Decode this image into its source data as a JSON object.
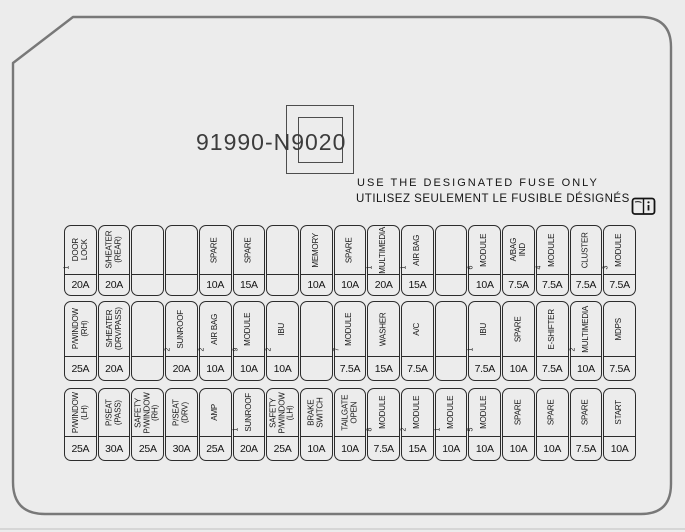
{
  "part_number": "91990-N9020",
  "notice": {
    "line_en": "USE THE DESIGNATED FUSE ONLY",
    "line_fr": "UTILISEZ SEULEMENT LE FUSIBLE DÉSIGNÉS",
    "icon": "owners-manual-book-icon"
  },
  "colors": {
    "background": "#ececec",
    "cell_line": "#2c2c2c",
    "casing_line": "#787878",
    "text": "#1a1a1a"
  },
  "fuse_rows": [
    {
      "cells": [
        {
          "label": "DOOR\nLOCK",
          "sup": "1",
          "amp": "20A"
        },
        {
          "label": "S/HEATER\n(REAR)",
          "sup": "",
          "amp": "20A"
        },
        {
          "label": "",
          "sup": "",
          "amp": ""
        },
        {
          "label": "",
          "sup": "",
          "amp": ""
        },
        {
          "label": "SPARE",
          "sup": "",
          "amp": "10A"
        },
        {
          "label": "SPARE",
          "sup": "",
          "amp": "15A"
        },
        {
          "label": "",
          "sup": "",
          "amp": ""
        },
        {
          "label": "MEMORY",
          "sup": "",
          "amp": "10A"
        },
        {
          "label": "SPARE",
          "sup": "",
          "amp": "10A"
        },
        {
          "label": "MULTIMEDIA",
          "sup": "1",
          "amp": "20A"
        },
        {
          "label": "AIR BAG",
          "sup": "1",
          "amp": "15A"
        },
        {
          "label": "",
          "sup": "",
          "amp": ""
        },
        {
          "label": "MODULE",
          "sup": "6",
          "amp": "10A"
        },
        {
          "label": "A/BAG\nIND",
          "sup": "",
          "amp": "7.5A"
        },
        {
          "label": "MODULE",
          "sup": "4",
          "amp": "7.5A"
        },
        {
          "label": "CLUSTER",
          "sup": "",
          "amp": "7.5A"
        },
        {
          "label": "MODULE",
          "sup": "3",
          "amp": "7.5A"
        }
      ]
    },
    {
      "cells": [
        {
          "label": "P/WINDOW\n(RH)",
          "sup": "",
          "amp": "25A"
        },
        {
          "label": "S/HEATER\n(DRV/PASS)",
          "sup": "",
          "amp": "20A"
        },
        {
          "label": "",
          "sup": "",
          "amp": ""
        },
        {
          "label": "SUNROOF",
          "sup": "2",
          "amp": "20A"
        },
        {
          "label": "AIR BAG",
          "sup": "2",
          "amp": "10A"
        },
        {
          "label": "MODULE",
          "sup": "9",
          "amp": "10A"
        },
        {
          "label": "IBU",
          "sup": "2",
          "amp": "10A"
        },
        {
          "label": "",
          "sup": "",
          "amp": ""
        },
        {
          "label": "MODULE",
          "sup": "7",
          "amp": "7.5A"
        },
        {
          "label": "WASHER",
          "sup": "",
          "amp": "15A"
        },
        {
          "label": "A/C",
          "sup": "",
          "amp": "7.5A"
        },
        {
          "label": "",
          "sup": "",
          "amp": ""
        },
        {
          "label": "IBU",
          "sup": "1",
          "amp": "7.5A"
        },
        {
          "label": "SPARE",
          "sup": "",
          "amp": "10A"
        },
        {
          "label": "E-SHIFTER",
          "sup": "",
          "amp": "7.5A"
        },
        {
          "label": "MULTIMEDIA",
          "sup": "2",
          "amp": "10A"
        },
        {
          "label": "MDPS",
          "sup": "",
          "amp": "7.5A"
        }
      ]
    },
    {
      "cells": [
        {
          "label": "P/WINDOW\n(LH)",
          "sup": "",
          "amp": "25A"
        },
        {
          "label": "P/SEAT\n(PASS)",
          "sup": "",
          "amp": "30A"
        },
        {
          "label": "SAFETY\nP/WINDOW\n(RH)",
          "sup": "",
          "amp": "25A"
        },
        {
          "label": "P/SEAT\n(DRV)",
          "sup": "",
          "amp": "30A"
        },
        {
          "label": "AMP",
          "sup": "",
          "amp": "25A"
        },
        {
          "label": "SUNROOF",
          "sup": "1",
          "amp": "20A"
        },
        {
          "label": "SAFETY\nP/WINDOW\n(LH)",
          "sup": "",
          "amp": "25A"
        },
        {
          "label": "BRAKE\nSWITCH",
          "sup": "",
          "amp": "10A"
        },
        {
          "label": "TAILGATE\nOPEN",
          "sup": "",
          "amp": "10A"
        },
        {
          "label": "MODULE",
          "sup": "8",
          "amp": "7.5A"
        },
        {
          "label": "MODULE",
          "sup": "2",
          "amp": "15A"
        },
        {
          "label": "MODULE",
          "sup": "1",
          "amp": "10A"
        },
        {
          "label": "MODULE",
          "sup": "5",
          "amp": "10A"
        },
        {
          "label": "SPARE",
          "sup": "",
          "amp": "10A"
        },
        {
          "label": "SPARE",
          "sup": "",
          "amp": "10A"
        },
        {
          "label": "SPARE",
          "sup": "",
          "amp": "7.5A"
        },
        {
          "label": "START",
          "sup": "",
          "amp": "10A"
        }
      ]
    }
  ]
}
